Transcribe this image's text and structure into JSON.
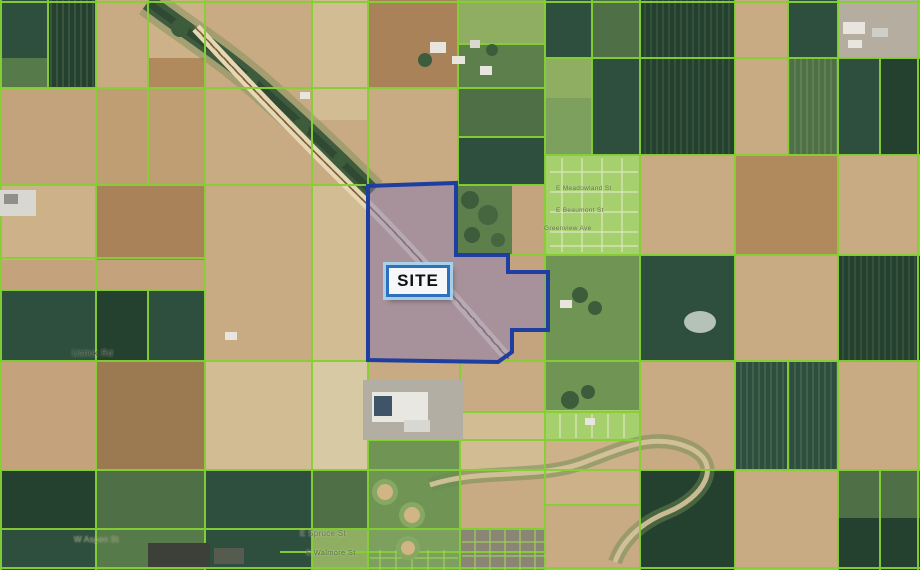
{
  "map": {
    "site": {
      "label": "SITE"
    },
    "street_labels": [
      {
        "id": "ustick",
        "text": "Ustick Rd"
      },
      {
        "id": "sub1",
        "text": "E Meadowland St"
      },
      {
        "id": "sub2",
        "text": "E Beaumont St"
      },
      {
        "id": "sub3",
        "text": "Greenview Ave"
      },
      {
        "id": "spruce",
        "text": "E Spruce St"
      },
      {
        "id": "walmore",
        "text": "E Walmore St"
      },
      {
        "id": "aspen",
        "text": "W Aspen St"
      }
    ],
    "colors": {
      "parcel_line": "#85d133",
      "site_fill": "#8e80b4",
      "site_border": "#1e3f9f",
      "site_label_border": "#2e6fc0",
      "site_label_bg": "#f5f7f8",
      "site_label_text": "#111111"
    }
  }
}
